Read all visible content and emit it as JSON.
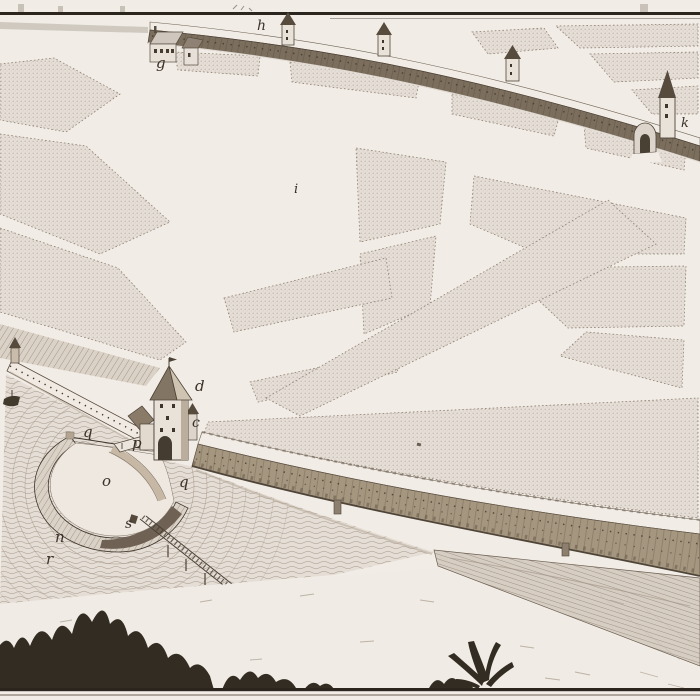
{
  "figure": {
    "kind": "engraved-birds-eye-view",
    "subject": "Fortified town wall with gate tower, half-moon ravelin, moat and field plots",
    "labels": [
      {
        "char": "g",
        "x": 156,
        "y": 68,
        "size": 15
      },
      {
        "char": "h",
        "x": 257,
        "y": 30,
        "size": 14
      },
      {
        "char": "k",
        "x": 681,
        "y": 127,
        "size": 13
      },
      {
        "char": "i",
        "x": 294,
        "y": 193,
        "size": 13
      },
      {
        "char": "d",
        "x": 195,
        "y": 391,
        "size": 15
      },
      {
        "char": "c",
        "x": 192,
        "y": 427,
        "size": 14
      },
      {
        "char": "q",
        "x": 83,
        "y": 437,
        "size": 15
      },
      {
        "char": "p",
        "x": 132,
        "y": 448,
        "size": 15
      },
      {
        "char": "o",
        "x": 102,
        "y": 486,
        "size": 15
      },
      {
        "char": "q",
        "x": 179,
        "y": 487,
        "size": 15
      },
      {
        "char": "s",
        "x": 125,
        "y": 528,
        "size": 14
      },
      {
        "char": "n",
        "x": 55,
        "y": 542,
        "size": 15
      },
      {
        "char": "r",
        "x": 46,
        "y": 564,
        "size": 15
      }
    ]
  },
  "palette": {
    "paper": "#ece6e0",
    "road": "#f1ece6",
    "field": "#e6dfd8",
    "fieldDot": "#9d9083",
    "ink": "#3d342a",
    "line": "#6b5f51",
    "wallNorth": "#7b6e5d",
    "wallSouth": "#a5967f",
    "wallDark": "#5b4f41",
    "water": "#e5ded6",
    "ripple": "#a89a8b",
    "rampart": "#93836f",
    "bank": "#d9d0c5",
    "bush": "#332c22",
    "borderLine": "#2b251e",
    "building": "#e9e2d9",
    "roof": "#8e8070"
  }
}
